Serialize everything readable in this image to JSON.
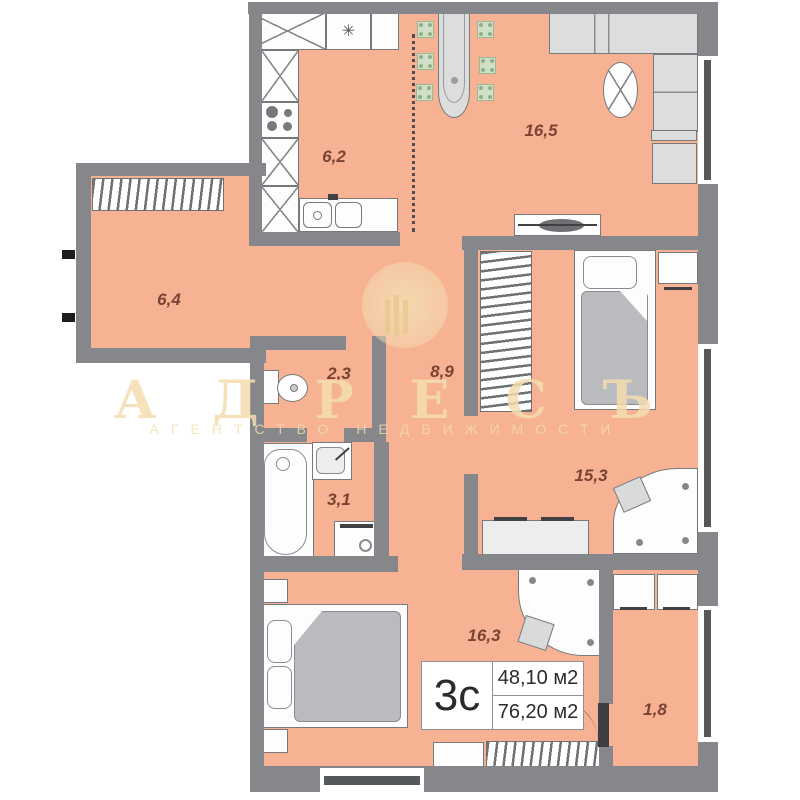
{
  "plan_type": "apartment-floor-plan",
  "rooms": [
    {
      "name": "kitchen",
      "area": "6,2"
    },
    {
      "name": "living-room",
      "area": "16,5"
    },
    {
      "name": "hallway",
      "area": "6,4"
    },
    {
      "name": "toilet",
      "area": "2,3"
    },
    {
      "name": "corridor",
      "area": "8,9"
    },
    {
      "name": "bathroom",
      "area": "3,1"
    },
    {
      "name": "bedroom-1",
      "area": "15,3"
    },
    {
      "name": "bedroom-2",
      "area": "16,3"
    },
    {
      "name": "balcony",
      "area": "1,8"
    }
  ],
  "info_box": {
    "type_label": "3с",
    "area_living": "48,10 м2",
    "area_total": "76,20 м2"
  },
  "watermark": {
    "title": "АДРЕСЪ",
    "subtitle": "АГЕНТСТВО НЕДВИЖИМОСТИ"
  },
  "icons": {
    "fridge_snowflake": "✳"
  },
  "colors": {
    "floor": "#f6b292",
    "wall": "#85878a",
    "room_label": "#7b4334",
    "chair_green": "#cfe0c6",
    "window_glass": "#55585b",
    "watermark_cream": "#f3ddaf",
    "info_text": "#2b2b2b"
  }
}
